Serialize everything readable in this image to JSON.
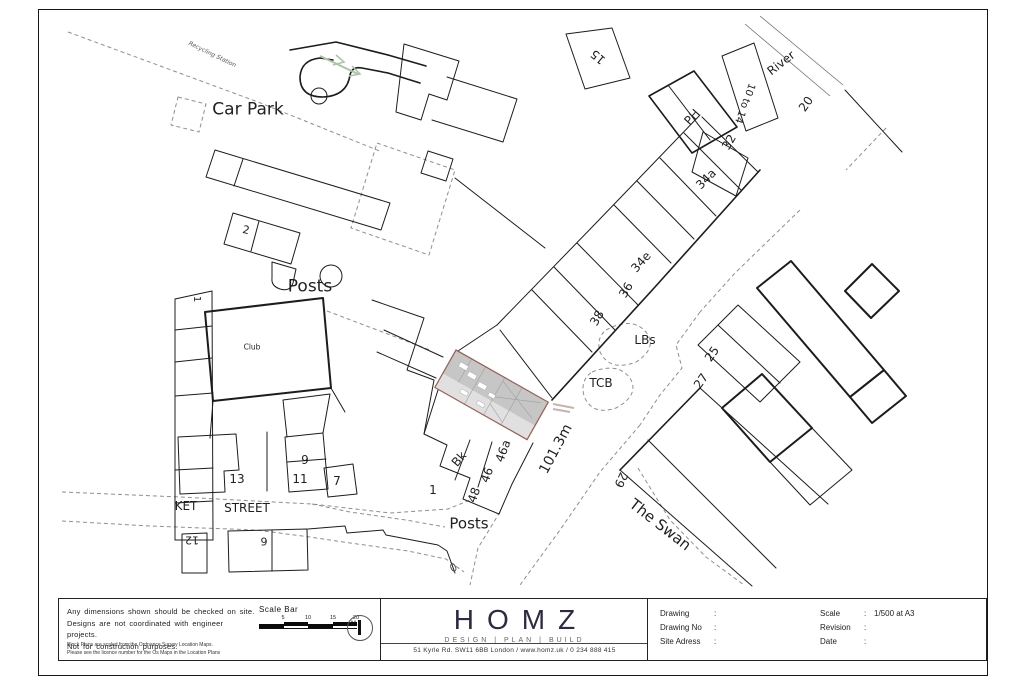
{
  "colors": {
    "site_fill_upper": "#c6c6c6",
    "site_fill_lower": "#e0e0e0",
    "site_outline": "#9a5e55",
    "flow_arrow_green": "#a9c6a4",
    "logo_navy": "#2e2a45"
  },
  "map": {
    "labels": [
      {
        "t": "Recycling Station",
        "x": 212,
        "y": 55,
        "s": 6,
        "r": 26,
        "it": true
      },
      {
        "t": "Car Park",
        "x": 248,
        "y": 110,
        "s": 17,
        "r": 0
      },
      {
        "t": "2",
        "x": 246,
        "y": 230,
        "s": 11,
        "r": 12
      },
      {
        "t": "Posts",
        "x": 310,
        "y": 287,
        "s": 17,
        "r": 0
      },
      {
        "t": "Club",
        "x": 252,
        "y": 347,
        "s": 7.5,
        "r": 0
      },
      {
        "t": "1",
        "x": 196,
        "y": 299,
        "s": 10,
        "r": 90
      },
      {
        "t": "13",
        "x": 237,
        "y": 479,
        "s": 12,
        "r": 0
      },
      {
        "t": "9",
        "x": 305,
        "y": 460,
        "s": 12,
        "r": 0
      },
      {
        "t": "11",
        "x": 300,
        "y": 479,
        "s": 12,
        "r": 0
      },
      {
        "t": "7",
        "x": 337,
        "y": 481,
        "s": 12,
        "r": 0
      },
      {
        "t": "KET",
        "x": 186,
        "y": 506,
        "s": 12,
        "r": 0
      },
      {
        "t": "STREET",
        "x": 247,
        "y": 508,
        "s": 12,
        "r": 0
      },
      {
        "t": "12",
        "x": 192,
        "y": 540,
        "s": 11,
        "r": 180
      },
      {
        "t": "6",
        "x": 264,
        "y": 541,
        "s": 11,
        "r": 180
      },
      {
        "t": "Posts",
        "x": 469,
        "y": 524,
        "s": 15,
        "r": 0
      },
      {
        "t": "0",
        "x": 453,
        "y": 567,
        "s": 11,
        "r": 140,
        "it": true
      },
      {
        "t": "1",
        "x": 433,
        "y": 490,
        "s": 12,
        "r": 0
      },
      {
        "t": "Bk",
        "x": 459,
        "y": 459,
        "s": 12,
        "r": -50
      },
      {
        "t": "48",
        "x": 474,
        "y": 495,
        "s": 12,
        "r": -70
      },
      {
        "t": "46",
        "x": 487,
        "y": 475,
        "s": 12,
        "r": -70
      },
      {
        "t": "46a",
        "x": 503,
        "y": 451,
        "s": 12,
        "r": -70
      },
      {
        "t": "101.3m",
        "x": 556,
        "y": 449,
        "s": 14,
        "r": -62
      },
      {
        "t": "TCB",
        "x": 601,
        "y": 383,
        "s": 12,
        "r": 0
      },
      {
        "t": "LBs",
        "x": 645,
        "y": 340,
        "s": 12,
        "r": 0
      },
      {
        "t": "38",
        "x": 597,
        "y": 318,
        "s": 12,
        "r": -60
      },
      {
        "t": "36",
        "x": 626,
        "y": 290,
        "s": 12,
        "r": -60
      },
      {
        "t": "34e",
        "x": 641,
        "y": 262,
        "s": 12,
        "r": -48
      },
      {
        "t": "34a",
        "x": 706,
        "y": 179,
        "s": 12,
        "r": -45
      },
      {
        "t": "PH",
        "x": 692,
        "y": 117,
        "s": 12,
        "r": -48
      },
      {
        "t": "32",
        "x": 729,
        "y": 142,
        "s": 12,
        "r": -60
      },
      {
        "t": "10 to 14",
        "x": 744,
        "y": 103,
        "s": 10,
        "r": 110
      },
      {
        "t": "River",
        "x": 781,
        "y": 63,
        "s": 12,
        "r": -38
      },
      {
        "t": "15",
        "x": 598,
        "y": 57,
        "s": 12,
        "r": -140
      },
      {
        "t": "20",
        "x": 806,
        "y": 104,
        "s": 12,
        "r": -55
      },
      {
        "t": "25",
        "x": 712,
        "y": 354,
        "s": 12,
        "r": -55
      },
      {
        "t": "27",
        "x": 701,
        "y": 381,
        "s": 12,
        "r": -55
      },
      {
        "t": "29",
        "x": 621,
        "y": 480,
        "s": 12,
        "r": 115
      },
      {
        "t": "The Swan",
        "x": 660,
        "y": 525,
        "s": 15,
        "r": 38
      }
    ]
  },
  "title_block": {
    "notes": {
      "lines": [
        "Any dimensions shown should be checked on site.",
        "Designs are not coordinated with engineer projects.",
        "Not for construction purposes."
      ],
      "small": [
        "Block Plans are scaled from the Ordnance Survey Location Maps.",
        "Please see the licence number for the Os Maps in the Location Plans"
      ]
    },
    "scale_bar": {
      "label": "Scale Bar",
      "ticks": [
        "5",
        "10",
        "15",
        "20"
      ],
      "unit": "M."
    },
    "logo": {
      "name": "HOMZ",
      "tagline": "DESIGN | PLAN | BUILD",
      "address": "51 Kyrle Rd. SW11 6BB London / www.homz.uk / 0 234 888 415"
    },
    "info": {
      "left": [
        {
          "label": "Drawing",
          "value": ""
        },
        {
          "label": "Drawing No",
          "value": ""
        },
        {
          "label": "Site Adress",
          "value": ""
        }
      ],
      "right": [
        {
          "label": "Scale",
          "value": "1/500 at A3"
        },
        {
          "label": "Revision",
          "value": ""
        },
        {
          "label": "Date",
          "value": ""
        }
      ]
    }
  }
}
